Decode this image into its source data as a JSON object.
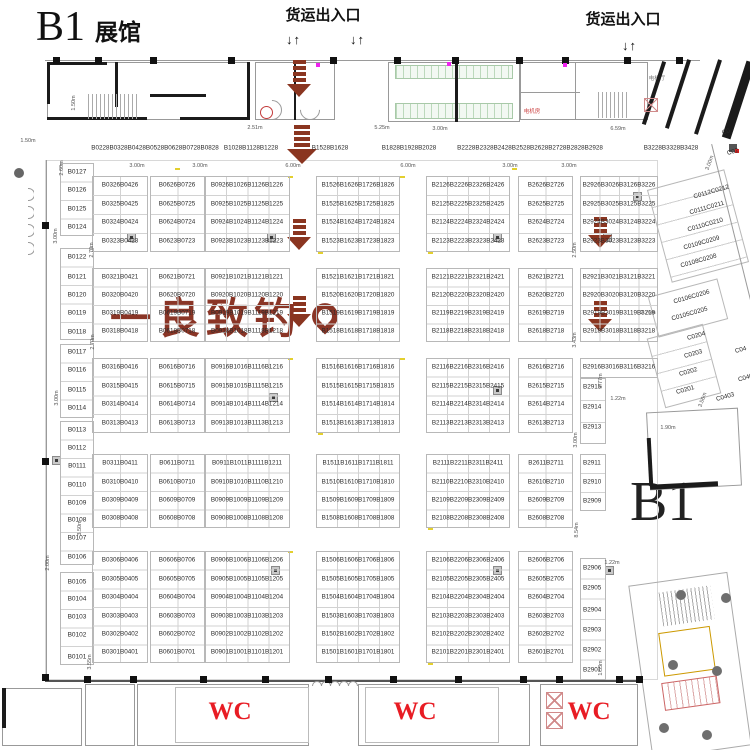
{
  "title": {
    "main": "B1",
    "sub": "展馆"
  },
  "labels": {
    "freight": "货运出入口",
    "arrow_pair": "↓↑",
    "b1_zone": "B1",
    "wc": "WC",
    "elevator_hall": "电梯厅",
    "machine_room": "电机房"
  },
  "watermark": {
    "text": "一良致钓",
    "color": "#8a3526"
  },
  "colors": {
    "freight_arrow": "#8a3520",
    "wc_red": "#e81c24",
    "wall": "#1b1b1b",
    "grid_line": "#c9c9c9"
  },
  "header_groups": [
    {
      "t": "B0228B0328B0428B0528B0628B0728B0828",
      "x": 155
    },
    {
      "t": "B1028B1128B1228",
      "x": 251
    },
    {
      "t": "B1528B1628",
      "x": 330
    },
    {
      "t": "B1828B1928B2028",
      "x": 409
    },
    {
      "t": "B2228B2328B2428B2528B2628B2728B2828B2928",
      "x": 530
    },
    {
      "t": "B3228B3328B3428",
      "x": 671
    }
  ],
  "left_booths": [
    {
      "code": "B0127",
      "y": 172
    },
    {
      "code": "B0126",
      "y": 190
    },
    {
      "code": "B0125",
      "y": 209
    },
    {
      "code": "B0124",
      "y": 227
    },
    {
      "code": "B0122",
      "y": 257
    },
    {
      "code": "B0121",
      "y": 277
    },
    {
      "code": "B0120",
      "y": 295
    },
    {
      "code": "B0119",
      "y": 313
    },
    {
      "code": "B0118",
      "y": 332
    },
    {
      "code": "B0117",
      "y": 352
    },
    {
      "code": "B0116",
      "y": 370
    },
    {
      "code": "B0115",
      "y": 390
    },
    {
      "code": "B0114",
      "y": 408
    },
    {
      "code": "B0113",
      "y": 430
    },
    {
      "code": "B0112",
      "y": 448
    },
    {
      "code": "B0111",
      "y": 466
    },
    {
      "code": "B0110",
      "y": 485
    },
    {
      "code": "B0109",
      "y": 503
    },
    {
      "code": "B0108",
      "y": 520
    },
    {
      "code": "B0107",
      "y": 538
    },
    {
      "code": "B0106",
      "y": 557
    },
    {
      "code": "B0105",
      "y": 582
    },
    {
      "code": "B0104",
      "y": 599
    },
    {
      "code": "B0103",
      "y": 617
    },
    {
      "code": "B0102",
      "y": 635
    },
    {
      "code": "B0101",
      "y": 657
    }
  ],
  "grid": {
    "columns": [
      {
        "name": "B03-B04",
        "groups": [
          [
            "B0326B0426",
            "B0325B0425",
            "B0324B0424",
            "B0323B0423"
          ],
          [
            "B0321B0421",
            "B0320B0420",
            "B0319B0419",
            "B0318B0418"
          ],
          [
            "B0316B0416",
            "B0315B0415",
            "B0314B0414",
            "B0313B0413"
          ],
          [
            "B0311B0411",
            "B0310B0410",
            "B0309B0409",
            "B0308B0408"
          ],
          [
            "B0306B0406",
            "B0305B0405",
            "B0304B0404",
            "B0303B0403",
            "B0302B0402",
            "B0301B0401"
          ]
        ]
      },
      {
        "name": "B06-B07",
        "groups": [
          [
            "B0626B0726",
            "B0625B0725",
            "B0624B0724",
            "B0623B0723"
          ],
          [
            "B0621B0721",
            "B0620B0720",
            "B0619B0719",
            "B0618B0718"
          ],
          [
            "B0616B0716",
            "B0615B0715",
            "B0614B0714",
            "B0613B0713"
          ],
          [
            "B0611B0711",
            "B0610B0710",
            "B0609B0709",
            "B0608B0708"
          ],
          [
            "B0606B0706",
            "B0605B0705",
            "B0604B0704",
            "B0603B0703",
            "B0602B0702",
            "B0601B0701"
          ]
        ]
      },
      {
        "name": "B09-B12",
        "groups": [
          [
            "B0926B1026B1126B1226",
            "B0925B1025B1125B1225",
            "B0924B1024B1124B1224",
            "B0923B1023B1123B1223"
          ],
          [
            "B0921B1021B1121B1221",
            "B0920B1020B1120B1220",
            "B0919B1019B1119B1219",
            "B0918B1018B1118B1218"
          ],
          [
            "B0916B1016B1116B1216",
            "B0915B1015B1115B1215",
            "B0914B1014B1114B1214",
            "B0913B1013B1113B1213"
          ],
          [
            "B0911B1011B1111B1211",
            "B0910B1010B1110B1210",
            "B0909B1009B1109B1209",
            "B0908B1008B1108B1208"
          ],
          [
            "B0906B1006B1106B1206",
            "B0905B1005B1105B1205",
            "B0904B1004B1104B1204",
            "B0903B1003B1103B1203",
            "B0902B1002B1102B1202",
            "B0901B1001B1101B1201"
          ]
        ]
      },
      {
        "name": "B15-B18",
        "groups": [
          [
            "B1526B1626B1726B1826",
            "B1525B1625B1725B1825",
            "B1524B1624B1724B1824",
            "B1523B1623B1723B1823"
          ],
          [
            "B1521B1621B1721B1821",
            "B1520B1620B1720B1820",
            "B1519B1619B1719B1819",
            "B1518B1618B1718B1818"
          ],
          [
            "B1516B1616B1716B1816",
            "B1515B1615B1715B1815",
            "B1514B1614B1714B1814",
            "B1513B1613B1713B1813"
          ],
          [
            "B1511B1611B1711B1811",
            "B1510B1610B1710B1810",
            "B1509B1609B1709B1809",
            "B1508B1608B1708B1808"
          ],
          [
            "B1506B1606B1706B1806",
            "B1505B1605B1705B1805",
            "B1504B1604B1704B1804",
            "B1503B1603B1703B1803",
            "B1502B1602B1702B1802",
            "B1501B1601B1701B1801"
          ]
        ]
      },
      {
        "name": "B21-B24",
        "groups": [
          [
            "B2126B2226B2326B2426",
            "B2125B2225B2325B2425",
            "B2124B2224B2324B2424",
            "B2123B2223B2323B2423"
          ],
          [
            "B2121B2221B2321B2421",
            "B2120B2220B2320B2420",
            "B2119B2219B2319B2419",
            "B2118B2218B2318B2418"
          ],
          [
            "B2116B2216B2316B2416",
            "B2115B2215B2315B2415",
            "B2114B2214B2314B2414",
            "B2113B2213B2313B2413"
          ],
          [
            "B2111B2211B2311B2411",
            "B2110B2210B2310B2410",
            "B2109B2209B2309B2409",
            "B2108B2208B2308B2408"
          ],
          [
            "B2106B2206B2306B2406",
            "B2105B2205B2305B2405",
            "B2104B2204B2304B2404",
            "B2103B2203B2303B2403",
            "B2102B2202B2302B2402",
            "B2101B2201B2301B2401"
          ]
        ]
      },
      {
        "name": "B26-B27",
        "groups": [
          [
            "B2626B2726",
            "B2625B2725",
            "B2624B2724",
            "B2623B2723"
          ],
          [
            "B2621B2721",
            "B2620B2720",
            "B2619B2719",
            "B2618B2718"
          ],
          [
            "B2616B2716",
            "B2615B2715",
            "B2614B2714",
            "B2613B2713"
          ],
          [
            "B2611B2711",
            "B2610B2710",
            "B2609B2709",
            "B2608B2708"
          ],
          [
            "B2606B2706",
            "B2605B2705",
            "B2604B2704",
            "B2603B2703",
            "B2602B2702",
            "B2601B2701"
          ]
        ]
      }
    ],
    "column7": {
      "name": "B29-B32",
      "groups": [
        [
          "B2926B3026B3126B3226",
          "B2925B3025B3125B3225",
          "B2924B3024B3124B3224",
          "B2923B3023B3123B3223"
        ],
        [
          "B2921B3021B3121B3221",
          "B2920B3020B3120B3220",
          "B2919B3019B3119B3219",
          "B2918B3018B3118B3218"
        ]
      ],
      "row16": "B2916B3016B3116B3216",
      "singles": [
        {
          "code": "B2915",
          "y": 387
        },
        {
          "code": "B2914",
          "y": 407
        },
        {
          "code": "B2913",
          "y": 427
        },
        {
          "code": "B2911",
          "y": 463
        },
        {
          "code": "B2910",
          "y": 482
        },
        {
          "code": "B2909",
          "y": 501
        },
        {
          "code": "B2906",
          "y": 568
        },
        {
          "code": "B2905",
          "y": 588
        },
        {
          "code": "B2904",
          "y": 610
        },
        {
          "code": "B2903",
          "y": 630
        },
        {
          "code": "B2902",
          "y": 650
        },
        {
          "code": "B2901",
          "y": 670
        }
      ]
    }
  },
  "c_wing": {
    "labels": [
      {
        "t": "C0112C0212",
        "x": 693,
        "y": 192
      },
      {
        "t": "C0111C0211",
        "x": 689,
        "y": 208
      },
      {
        "t": "C0110C0210",
        "x": 687,
        "y": 225
      },
      {
        "t": "C0109C0209",
        "x": 683,
        "y": 243
      },
      {
        "t": "C0108C0208",
        "x": 680,
        "y": 261
      },
      {
        "t": "C0106C0206",
        "x": 673,
        "y": 297
      },
      {
        "t": "C0105C0205",
        "x": 671,
        "y": 314
      },
      {
        "t": "C0204",
        "x": 687,
        "y": 336
      },
      {
        "t": "C0203",
        "x": 684,
        "y": 354
      },
      {
        "t": "C0202",
        "x": 679,
        "y": 372
      },
      {
        "t": "C0201",
        "x": 676,
        "y": 390
      }
    ],
    "fragments": [
      {
        "t": "C0",
        "x": 722,
        "y": 132
      },
      {
        "t": "C02",
        "x": 727,
        "y": 152
      },
      {
        "t": "C04",
        "x": 735,
        "y": 350
      },
      {
        "t": "C040",
        "x": 738,
        "y": 378
      },
      {
        "t": "C0403",
        "x": 716,
        "y": 397
      }
    ]
  },
  "dimensions": [
    {
      "t": "1.50m",
      "x": 74,
      "y": 103,
      "r": 90
    },
    {
      "t": "1.50m",
      "x": 28,
      "y": 141,
      "r": 0
    },
    {
      "t": "2.51m",
      "x": 255,
      "y": 128,
      "r": 0
    },
    {
      "t": "5.25m",
      "x": 382,
      "y": 128,
      "r": 0
    },
    {
      "t": "3.00m",
      "x": 440,
      "y": 129,
      "r": 0
    },
    {
      "t": "6.59m",
      "x": 618,
      "y": 129,
      "r": 0
    },
    {
      "t": "3.00m",
      "x": 137,
      "y": 166,
      "r": 0
    },
    {
      "t": "3.00m",
      "x": 200,
      "y": 166,
      "r": 0
    },
    {
      "t": "6.00m",
      "x": 293,
      "y": 166,
      "r": 0
    },
    {
      "t": "6.00m",
      "x": 408,
      "y": 166,
      "r": 0
    },
    {
      "t": "3.00m",
      "x": 510,
      "y": 166,
      "r": 0
    },
    {
      "t": "3.00m",
      "x": 569,
      "y": 166,
      "r": 0
    },
    {
      "t": "2.60m",
      "x": 62,
      "y": 168,
      "r": 90
    },
    {
      "t": "2.70m",
      "x": 92,
      "y": 250,
      "r": 90
    },
    {
      "t": "2.70m",
      "x": 93,
      "y": 342,
      "r": 90
    },
    {
      "t": "3.00m",
      "x": 56,
      "y": 236,
      "r": 90
    },
    {
      "t": "3.00m",
      "x": 57,
      "y": 398,
      "r": 90
    },
    {
      "t": "3.50m",
      "x": 80,
      "y": 528,
      "r": 90
    },
    {
      "t": "2.00m",
      "x": 48,
      "y": 563,
      "r": 90
    },
    {
      "t": "3.55m",
      "x": 90,
      "y": 662,
      "r": 90
    },
    {
      "t": "2.50m",
      "x": 575,
      "y": 250,
      "r": 90
    },
    {
      "t": "3.43m",
      "x": 575,
      "y": 340,
      "r": 90
    },
    {
      "t": "2.76m",
      "x": 648,
      "y": 313,
      "r": 0
    },
    {
      "t": "3.00m",
      "x": 710,
      "y": 163,
      "r": 70
    },
    {
      "t": "3.77m",
      "x": 601,
      "y": 381,
      "r": 90
    },
    {
      "t": "1.22m",
      "x": 618,
      "y": 399,
      "r": 0
    },
    {
      "t": "3.00m",
      "x": 576,
      "y": 440,
      "r": 90
    },
    {
      "t": "1.90m",
      "x": 668,
      "y": 428,
      "r": 0
    },
    {
      "t": "8.54m",
      "x": 577,
      "y": 530,
      "r": 90
    },
    {
      "t": "1.22m",
      "x": 612,
      "y": 563,
      "r": 0
    },
    {
      "t": "1.53m",
      "x": 601,
      "y": 668,
      "r": 90
    },
    {
      "t": "3.56m",
      "x": 703,
      "y": 400,
      "r": 70
    }
  ],
  "freight_arrows": {
    "color": "#8a3520",
    "columns": [
      {
        "x": 287,
        "segments": [
          {
            "y": 60,
            "h": 40
          },
          {
            "y": 125,
            "h": 45
          },
          {
            "y": 219,
            "h": 32
          },
          {
            "y": 296,
            "h": 36
          }
        ]
      },
      {
        "x": 588,
        "segments": [
          {
            "y": 217,
            "h": 33
          },
          {
            "y": 301,
            "h": 33
          }
        ]
      }
    ]
  }
}
